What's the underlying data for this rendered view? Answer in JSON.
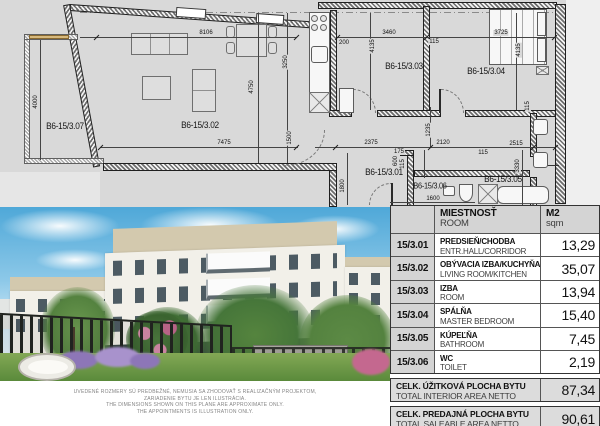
{
  "plan": {
    "rooms": [
      "B6-15/3.07",
      "B6-15/3.02",
      "B6-15/3.03",
      "B6-15/3.04",
      "B6-15/3.01",
      "B6-15/3.06",
      "B6-15/3.05"
    ],
    "dims": [
      "8106",
      "4750",
      "3250",
      "1500",
      "7475",
      "4000",
      "200",
      "3460",
      "115",
      "4135",
      "3725",
      "4135",
      "115",
      "1235",
      "2375",
      "175",
      "2120",
      "115",
      "2515",
      "3330",
      "600",
      "115",
      "1800",
      "1600"
    ]
  },
  "disclaimer": {
    "line1": "UVEDENÉ ROZMERY SÚ PREDBEŽNÉ, NEMUSIA SA ZHODOVAŤ S REALIZAČNÝM PROJEKTOM,",
    "line2": "ZARIADENIE BYTU JE LEN ILUSTRÁCIA.",
    "line3": "THE DIMENSIONS SHOWN ON THIS PLANE ARE APPROXIMATE ONLY.",
    "line4": "THE APPOINTMENTS IS ILLUSTRATION ONLY."
  },
  "table": {
    "header": {
      "room_sk": "MIESTNOSŤ",
      "room_en": "ROOM",
      "area_sk": "M2",
      "area_en": "sqm"
    },
    "rows": [
      {
        "code": "15/3.01",
        "name_sk": "PREDSIEŇ/CHODBA",
        "name_en": "ENTR.HALL/CORRIDOR",
        "area": "13,29"
      },
      {
        "code": "15/3.02",
        "name_sk": "OBÝVACIA IZBA/KUCHYŇA",
        "name_en": "LIVING ROOM/KITCHEN",
        "area": "35,07"
      },
      {
        "code": "15/3.03",
        "name_sk": "IZBA",
        "name_en": "ROOM",
        "area": "13,94"
      },
      {
        "code": "15/3.04",
        "name_sk": "SPÁLŇA",
        "name_en": "MASTER BEDROOM",
        "area": "15,40"
      },
      {
        "code": "15/3.05",
        "name_sk": "KÚPEĽŇA",
        "name_en": "BATHROOM",
        "area": "7,45"
      },
      {
        "code": "15/3.06",
        "name_sk": "WC",
        "name_en": "TOILET",
        "area": "2,19"
      }
    ],
    "totals": [
      {
        "name_sk": "CELK. ÚŽITKOVÁ PLOCHA BYTU",
        "name_en": "TOTAL INTERIOR AREA NETTO",
        "area": "87,34"
      },
      {
        "name_sk": "CELK. PREDAJNÁ PLOCHA BYTU",
        "name_en": "TOTAL SALEABLE AREA NETTO",
        "area": "90,61"
      }
    ]
  },
  "colors": {
    "plan_bg": "#d9d9d9",
    "table_header_bg": "#d4d4d4",
    "sky": "#5fb0de",
    "facade": "#f2f0e9",
    "penthouse_band": "#d3c9ae",
    "accent_wood": "#d7b97d"
  }
}
